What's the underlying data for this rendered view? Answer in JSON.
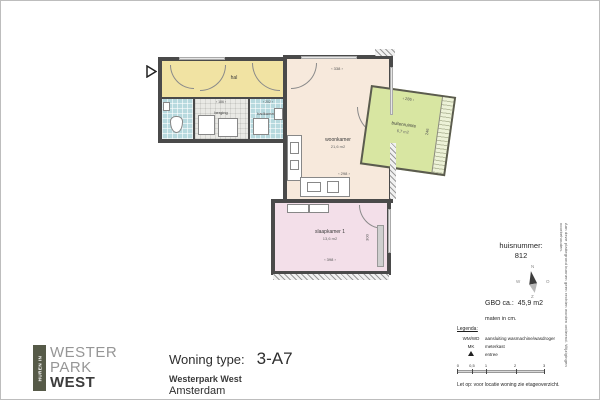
{
  "colors": {
    "wall": "#4a4a4a",
    "hal": "#f1e3a3",
    "wet_rooms": "#b7d9de",
    "berging": "#e9e9e5",
    "woonkamer": "#f7e9dc",
    "slaapkamer": "#f3dfe9",
    "buitenruimte": "#d8e6a2",
    "logo_bar": "#565a48"
  },
  "plan": {
    "rooms": {
      "hal": {
        "label": "hal"
      },
      "berging": {
        "label": "berging",
        "dim_top": "186"
      },
      "badkamer": {
        "label": "badkamer",
        "dim_top": "202"
      },
      "woonkamer": {
        "label": "woonkamer",
        "area": "21,6 m2",
        "dim_top": "338",
        "dim_right": "574",
        "dim_bottom": "298"
      },
      "slaapkamer1": {
        "label": "slaapkamer 1",
        "area": "13,6 m2",
        "dim_bottom": "398",
        "dim_right": "300"
      },
      "buitenruimte": {
        "label": "buitenruimte",
        "area": "6,7 m2",
        "dim_top": "286",
        "dim_right": "246"
      }
    }
  },
  "info": {
    "huisnummer_label": "huisnummer:",
    "huisnummer_value": "812",
    "compass": {
      "n": "N",
      "o": "O",
      "z": "Z",
      "w": "W"
    },
    "gbo_label": "GBO ca.:",
    "gbo_value": "45,9 m2",
    "maten_note": "maten in cm.",
    "legenda_title": "Legenda:",
    "legenda_items": [
      {
        "key": "WM/WD",
        "desc": "aansluiting wasmachine/wasdroger"
      },
      {
        "key": "MK",
        "desc": "meterkast"
      },
      {
        "key": "",
        "desc": "entree"
      }
    ],
    "scalebar_ticks": [
      "0",
      "0,5",
      "1",
      "2",
      "3"
    ],
    "let_op": "Let op:  voor locatie woning zie etageoverzicht.",
    "disclaimer": "Aan deze plattegrond kunnen geen rechten worden ontleend. Wijzigingen voorbehouden."
  },
  "footer": {
    "logo_vertical": "HUREN IN",
    "logo_line1": "WESTER",
    "logo_line2": "PARK",
    "logo_line3": "WEST",
    "type_label": "Woning type:",
    "type_value": "3-A7",
    "project": "Westerpark West",
    "city": "Amsterdam"
  }
}
